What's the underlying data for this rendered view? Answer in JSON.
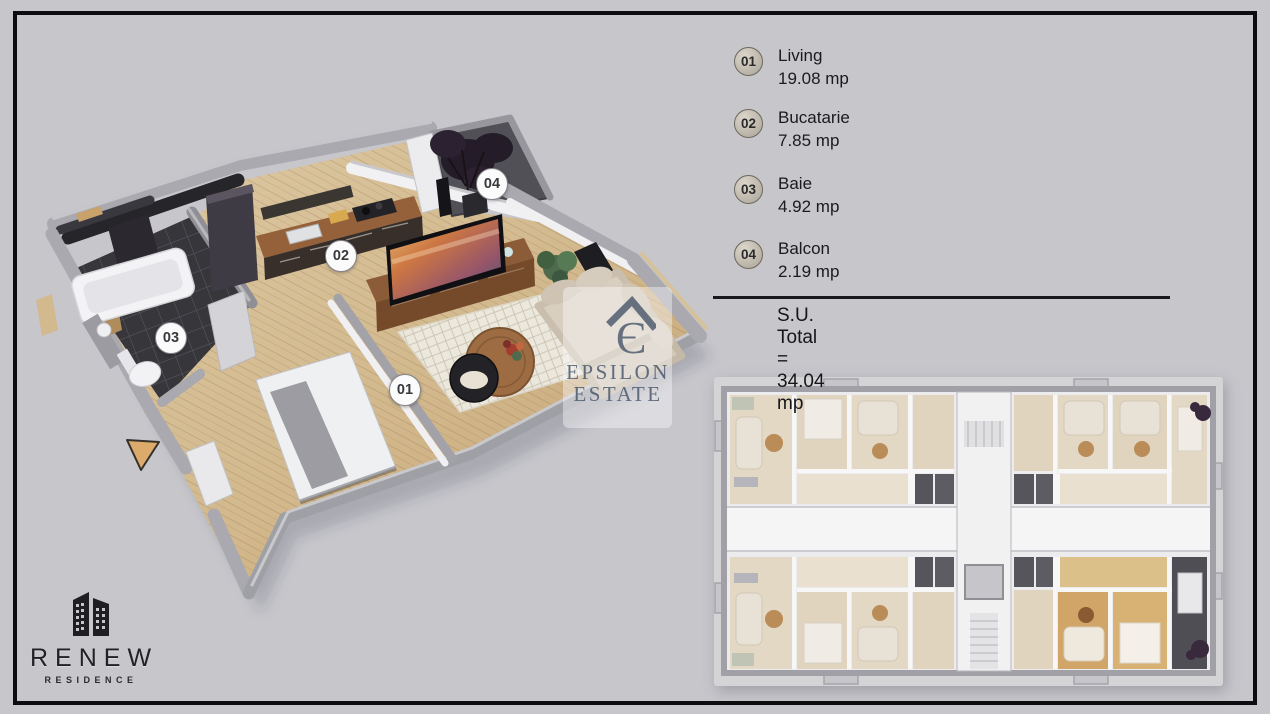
{
  "legend": {
    "items": [
      {
        "num": "01",
        "name": "Living",
        "area": "19.08 mp"
      },
      {
        "num": "02",
        "name": "Bucatarie",
        "area": "7.85 mp"
      },
      {
        "num": "03",
        "name": "Baie",
        "area": "4.92 mp"
      },
      {
        "num": "04",
        "name": "Balcon",
        "area": "2.19 mp"
      }
    ],
    "disclaimer": "Suprafetele sunt aproximative*",
    "total": "S.U. Total = 34.04 mp"
  },
  "plan": {
    "badges": [
      "01",
      "02",
      "03",
      "04"
    ]
  },
  "watermark": {
    "line1": "EPSILON",
    "line2": "ESTATE"
  },
  "logo": {
    "name": "RENEW",
    "subtitle": "RESIDENCE"
  },
  "colors": {
    "background": "#c6c6cb",
    "frame": "#0d0d0f",
    "wall_grey": "#a9a9af",
    "wood_floor": "#d7c09a",
    "dark_tile": "#36363b",
    "counter_wood": "#95613a",
    "badge_fill": "#cdc7bb",
    "highlight_unit_wood": "#d1a567",
    "watermark_blue": "#4a586c"
  }
}
